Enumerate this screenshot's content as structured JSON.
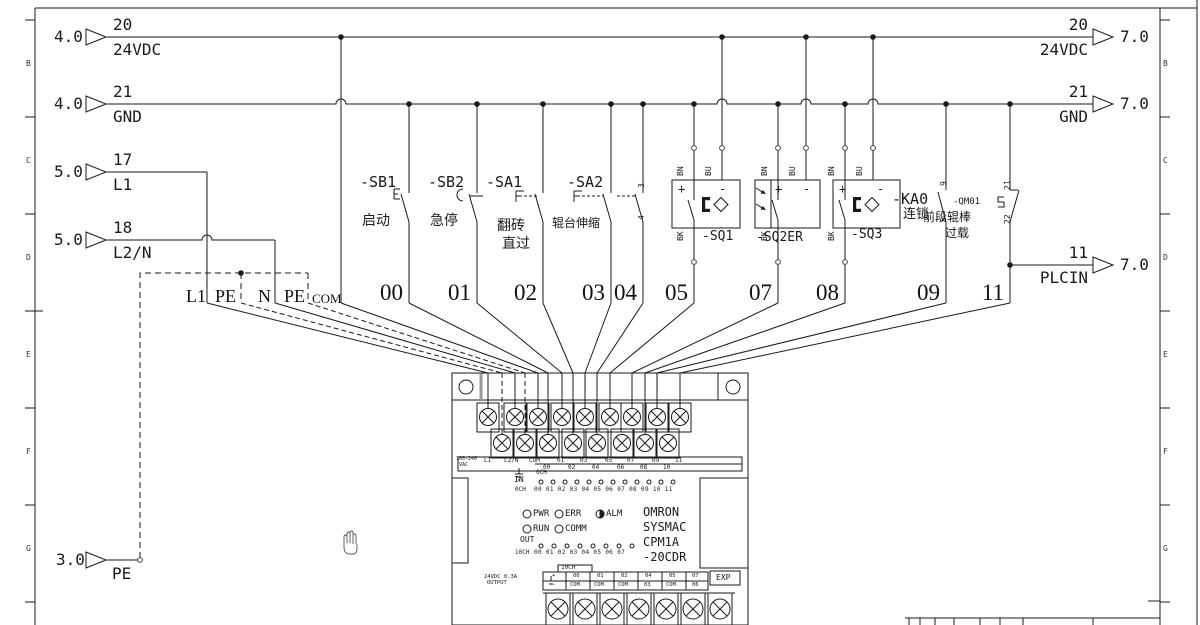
{
  "sym": {
    "plus": "+",
    "minus": "-"
  },
  "zones": {
    "letters": [
      "B",
      "C",
      "D",
      "E",
      "F",
      "G"
    ]
  },
  "refs": {
    "left": [
      {
        "page": "4.0",
        "wire": "20",
        "name": "24VDC"
      },
      {
        "page": "4.0",
        "wire": "21",
        "name": "GND"
      },
      {
        "page": "5.0",
        "wire": "17",
        "name": "L1"
      },
      {
        "page": "5.0",
        "wire": "18",
        "name": "L2/N"
      },
      {
        "page": "3.0",
        "name": "PE"
      }
    ],
    "right": [
      {
        "wire": "20",
        "name": "24VDC",
        "page": "7.0"
      },
      {
        "wire": "21",
        "name": "GND",
        "page": "7.0"
      },
      {
        "wire": "11",
        "name": "PLCIN",
        "page": "7.0"
      }
    ]
  },
  "wire_labels": {
    "l1": "L1",
    "pe1": "PE",
    "n": "N",
    "pe2": "PE",
    "com": "COM"
  },
  "channels": [
    "00",
    "01",
    "02",
    "03",
    "04",
    "05",
    "07",
    "08",
    "09",
    "11"
  ],
  "devices": [
    {
      "tag": "-SB1",
      "desc": "启动"
    },
    {
      "tag": "-SB2",
      "desc": "急停"
    },
    {
      "tag": "-SA1",
      "desc": "翻砖",
      "desc2": "直过"
    },
    {
      "tag": "-SA2",
      "desc": "辊台伸缩",
      "t1": "3",
      "t2": "4"
    },
    {
      "tag": "-SQ1",
      "bn": "BN",
      "bu": "BU",
      "bk": "BK"
    },
    {
      "tag": "-SQ2ER",
      "bn": "BN",
      "bu": "BU",
      "bk": "BK"
    },
    {
      "tag": "-SQ3",
      "bn": "BN",
      "bu": "BU",
      "bk": "BK"
    },
    {
      "tag": "-KA0",
      "desc": "连锁",
      "t1": "9",
      "t2": "5"
    },
    {
      "tag": "-QM01",
      "desc": "前段辊棒",
      "desc2": "过载",
      "t1": "21",
      "t2": "22"
    }
  ],
  "plc": {
    "vac1": "100-240",
    "vac2": "VAC",
    "in_top": [
      "L1",
      "L2/N",
      "COM",
      "01",
      "03",
      "05",
      "07",
      "09",
      "11"
    ],
    "in_bottom": [
      "00",
      "02",
      "04",
      "06",
      "08",
      "10"
    ],
    "in": "IN",
    "in_ch": "0CH",
    "in_led_ch": "0CH",
    "in_led_nums": "00 01 02 03 04 05 06 07 08 09 10 11",
    "leds": [
      "PWR",
      "ERR",
      "ALM",
      "RUN",
      "COMM"
    ],
    "out": "OUT",
    "out_ch": "10CH",
    "out_led_nums": "00 01 02 03 04 05 06 07",
    "brand": [
      "OMRON",
      "SYSMAC",
      "CPM1A",
      "-20CDR"
    ],
    "psu1": "24VDC 0.3A",
    "psu2": "OUTPUT",
    "out_ch2": "10CH",
    "out_top": [
      "+",
      "00",
      "01",
      "02",
      "04",
      "05",
      "07"
    ],
    "out_bottom": [
      "-",
      "COM",
      "COM",
      "COM",
      "03",
      "COM",
      "06"
    ],
    "exp": "EXP"
  }
}
